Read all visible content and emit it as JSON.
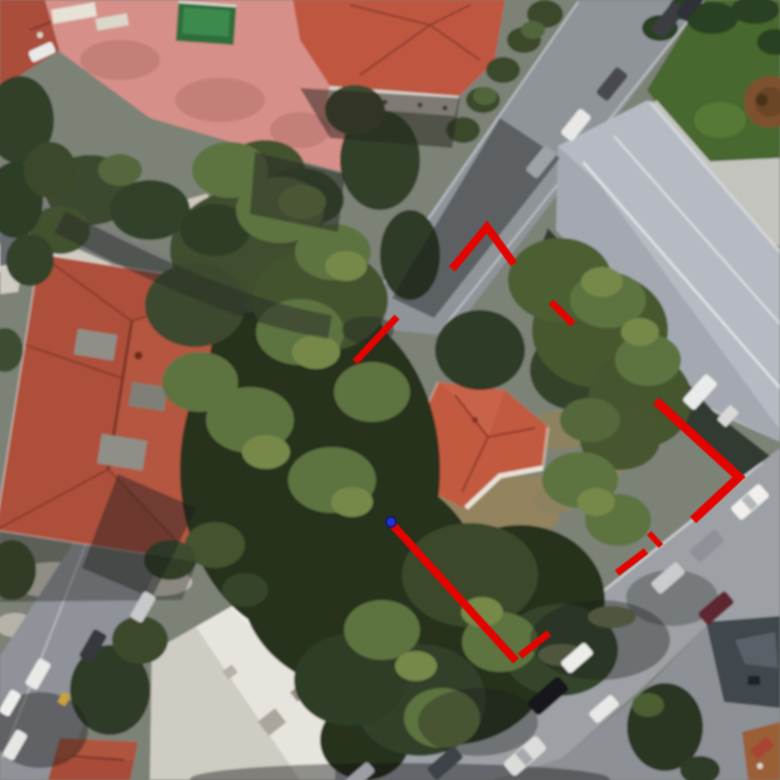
{
  "view": {
    "type": "satellite-aerial-photo",
    "width": 780,
    "height": 780,
    "description": "Aerial satellite view of a residential block: tiled-roof villas, pink courtyard with green pool, dense tree canopy over a parcel, long grey warehouse roof, streets with parked cars; the parcel is outlined with hand-drawn dashed red lines and a blue dot marks its west corner."
  },
  "annotation": {
    "boundary": {
      "color": "#e30400",
      "style": "dashed-handdrawn",
      "segments": [
        {
          "points": [
            [
              452,
              269
            ],
            [
              487,
              227
            ],
            [
              514,
              264
            ]
          ],
          "width": 8
        },
        {
          "points": [
            [
              551,
              302
            ],
            [
              573,
              324
            ]
          ],
          "width": 7
        },
        {
          "points": [
            [
              397,
              317
            ],
            [
              355,
              362
            ]
          ],
          "width": 7
        },
        {
          "points": [
            [
              656,
              401
            ],
            [
              739,
              477
            ],
            [
              693,
              520
            ]
          ],
          "width": 9
        },
        {
          "points": [
            [
              649,
              533
            ],
            [
              661,
              546
            ]
          ],
          "width": 6
        },
        {
          "points": [
            [
              646,
              551
            ],
            [
              617,
              573
            ]
          ],
          "width": 7
        },
        {
          "points": [
            [
              392,
              524
            ],
            [
              516,
              661
            ]
          ],
          "width": 8
        },
        {
          "points": [
            [
              520,
              656
            ],
            [
              549,
              633
            ]
          ],
          "width": 7
        }
      ]
    },
    "marker": {
      "name": "blue-location-dot",
      "x": 391,
      "y": 522,
      "radius": 5,
      "fill": "#2533cf",
      "stroke": "#0d1875"
    }
  },
  "scene": {
    "palette": {
      "road": "#9da1a5",
      "red_tile_roof": "#ae4f3b",
      "subject_house_roof": "#c25a40",
      "courtyard_pink": "#d69089",
      "warehouse_roof": "#b6bbc3",
      "lawn_green": "#47682f",
      "tree_dark": "#26301f",
      "tree_light": "#5d7340",
      "pool_green": "#3d8a4e",
      "white_flat_roof": "#e7e4dd"
    },
    "features": [
      "tiled-roof-villas",
      "pink-courtyard",
      "swimming-pool",
      "tree-canopy",
      "warehouse-roof",
      "streets",
      "parked-cars",
      "lawn",
      "white-flat-roof-building",
      "parcel-boundary-annotation",
      "blue-location-dot"
    ]
  }
}
